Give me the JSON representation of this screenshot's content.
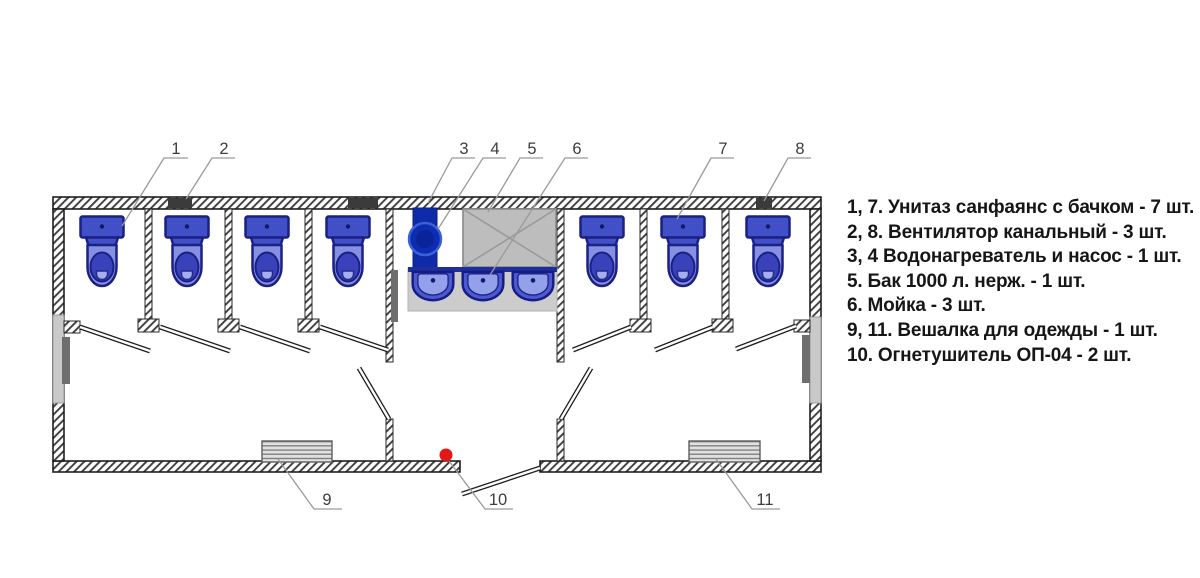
{
  "legend": {
    "items": [
      "1, 7. Унитаз санфаянс с бачком - 7 шт.",
      "2, 8. Вентилятор канальный - 3 шт.",
      "3, 4 Водонагреватель и насос - 1 шт.",
      "5. Бак 1000 л. нерж. - 1 шт.",
      "6. Мойка - 3 шт.",
      "9, 11. Вешалка для одежды - 1 шт.",
      "10. Огнетушитель ОП-04 - 2 шт."
    ]
  },
  "callouts": {
    "n1": "1",
    "n2": "2",
    "n3": "3",
    "n4": "4",
    "n5": "5",
    "n6": "6",
    "n7": "7",
    "n8": "8",
    "n9": "9",
    "n10": "10",
    "n11": "11"
  },
  "colors": {
    "toilet_blue": "#4150c6",
    "toilet_blue_light": "#8590e3",
    "equipment_navy": "#0e2aa9",
    "tank_gray": "#bdbdbd",
    "extinguisher_red": "#e41717",
    "vent_dark": "#3b3b3b"
  }
}
